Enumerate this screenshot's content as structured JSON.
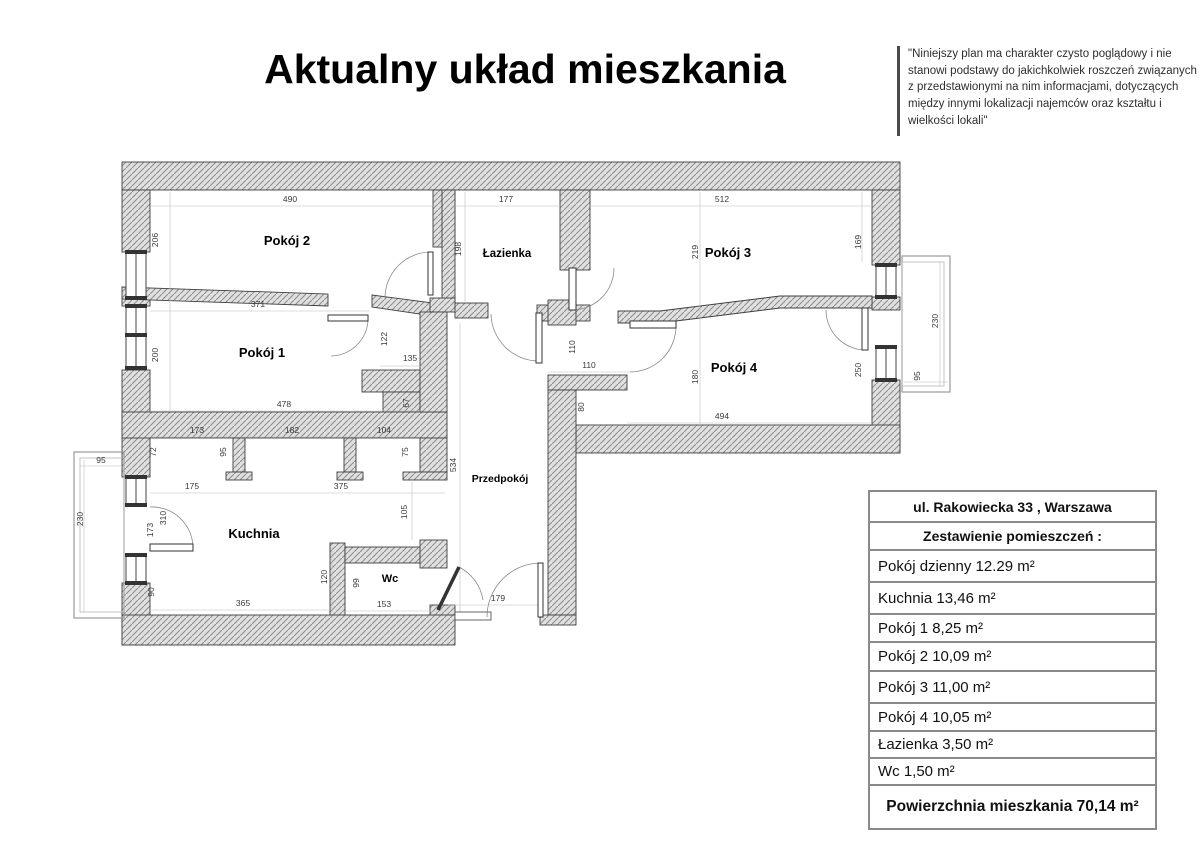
{
  "title": "Aktualny układ mieszkania",
  "disclaimer": "\"Niniejszy plan ma charakter czysto poglądowy i nie stanowi podstawy do jakichkolwiek roszczeń związanych z przedstawionymi na nim informacjami, dotyczących między innymi lokalizacji najemców oraz kształtu i wielkości lokali\"",
  "summary_table": {
    "address": "ul. Rakowiecka 33 , Warszawa",
    "subtitle": "Zestawienie pomieszczeń :",
    "rooms": [
      "Pokój dzienny 12.29 m²",
      "Kuchnia 13,46 m²",
      "Pokój 1 8,25 m²",
      "Pokój 2 10,09 m²",
      "Pokój 3 11,00 m²",
      "Pokój 4 10,05 m²",
      "Łazienka 3,50 m²",
      "Wc 1,50 m²"
    ],
    "total": "Powierzchnia mieszkania 70,14 m²"
  },
  "plan": {
    "room_labels": [
      {
        "label": "Pokój 2",
        "x": 287,
        "y": 245,
        "fs": 13
      },
      {
        "label": "Łazienka",
        "x": 507,
        "y": 257,
        "fs": 11.5
      },
      {
        "label": "Pokój 3",
        "x": 728,
        "y": 257,
        "fs": 13
      },
      {
        "label": "Pokój 1",
        "x": 262,
        "y": 357,
        "fs": 13
      },
      {
        "label": "Pokój 4",
        "x": 734,
        "y": 372,
        "fs": 13
      },
      {
        "label": "Kuchnia",
        "x": 254,
        "y": 538,
        "fs": 13
      },
      {
        "label": "Wc",
        "x": 390,
        "y": 582,
        "fs": 11
      },
      {
        "label": "Przedpokój",
        "x": 500,
        "y": 482,
        "fs": 10.5
      }
    ],
    "dimensions_cm": [
      {
        "v": "490",
        "x": 290,
        "y": 202,
        "r": 0
      },
      {
        "v": "206",
        "x": 158,
        "y": 240,
        "r": 1
      },
      {
        "v": "177",
        "x": 506,
        "y": 202,
        "r": 0
      },
      {
        "v": "198",
        "x": 461,
        "y": 249,
        "r": 1
      },
      {
        "v": "512",
        "x": 722,
        "y": 202,
        "r": 0
      },
      {
        "v": "219",
        "x": 698,
        "y": 252,
        "r": 1
      },
      {
        "v": "169",
        "x": 861,
        "y": 242,
        "r": 1
      },
      {
        "v": "371",
        "x": 258,
        "y": 307,
        "r": 0
      },
      {
        "v": "122",
        "x": 387,
        "y": 339,
        "r": 1
      },
      {
        "v": "200",
        "x": 158,
        "y": 355,
        "r": 1
      },
      {
        "v": "135",
        "x": 410,
        "y": 361,
        "r": 0
      },
      {
        "v": "67",
        "x": 409,
        "y": 403,
        "r": 1
      },
      {
        "v": "478",
        "x": 284,
        "y": 407,
        "r": 0
      },
      {
        "v": "110",
        "x": 575,
        "y": 347,
        "r": 1
      },
      {
        "v": "110",
        "x": 589,
        "y": 368,
        "r": 0
      },
      {
        "v": "80",
        "x": 584,
        "y": 407,
        "r": 1
      },
      {
        "v": "180",
        "x": 698,
        "y": 377,
        "r": 1
      },
      {
        "v": "250",
        "x": 861,
        "y": 370,
        "r": 1
      },
      {
        "v": "494",
        "x": 722,
        "y": 419,
        "r": 0
      },
      {
        "v": "173",
        "x": 197,
        "y": 433,
        "r": 0
      },
      {
        "v": "182",
        "x": 292,
        "y": 433,
        "r": 0
      },
      {
        "v": "104",
        "x": 384,
        "y": 433,
        "r": 0
      },
      {
        "v": "72",
        "x": 156,
        "y": 452,
        "r": 1
      },
      {
        "v": "95",
        "x": 226,
        "y": 452,
        "r": 1
      },
      {
        "v": "75",
        "x": 408,
        "y": 452,
        "r": 1
      },
      {
        "v": "175",
        "x": 192,
        "y": 489,
        "r": 0
      },
      {
        "v": "375",
        "x": 341,
        "y": 489,
        "r": 0
      },
      {
        "v": "105",
        "x": 407,
        "y": 512,
        "r": 1
      },
      {
        "v": "310",
        "x": 166,
        "y": 518,
        "r": 1
      },
      {
        "v": "173",
        "x": 153,
        "y": 530,
        "r": 1
      },
      {
        "v": "534",
        "x": 456,
        "y": 465,
        "r": 1
      },
      {
        "v": "90",
        "x": 154,
        "y": 592,
        "r": 1
      },
      {
        "v": "120",
        "x": 327,
        "y": 577,
        "r": 1
      },
      {
        "v": "99",
        "x": 359,
        "y": 583,
        "r": 1
      },
      {
        "v": "365",
        "x": 243,
        "y": 606,
        "r": 0
      },
      {
        "v": "153",
        "x": 384,
        "y": 607,
        "r": 0
      },
      {
        "v": "179",
        "x": 498,
        "y": 601,
        "r": 0
      },
      {
        "v": "95",
        "x": 101,
        "y": 463,
        "r": 0
      },
      {
        "v": "230",
        "x": 83,
        "y": 519,
        "r": 1
      },
      {
        "v": "230",
        "x": 938,
        "y": 321,
        "r": 1
      },
      {
        "v": "95",
        "x": 920,
        "y": 376,
        "r": 1
      }
    ]
  },
  "colors": {
    "wall_fill": "#e0e0e0",
    "wall_hatch": "#909090",
    "wall_outline": "#3f3f3f",
    "dim_text": "#3a3a3a",
    "table_border": "#8a8a8a"
  }
}
